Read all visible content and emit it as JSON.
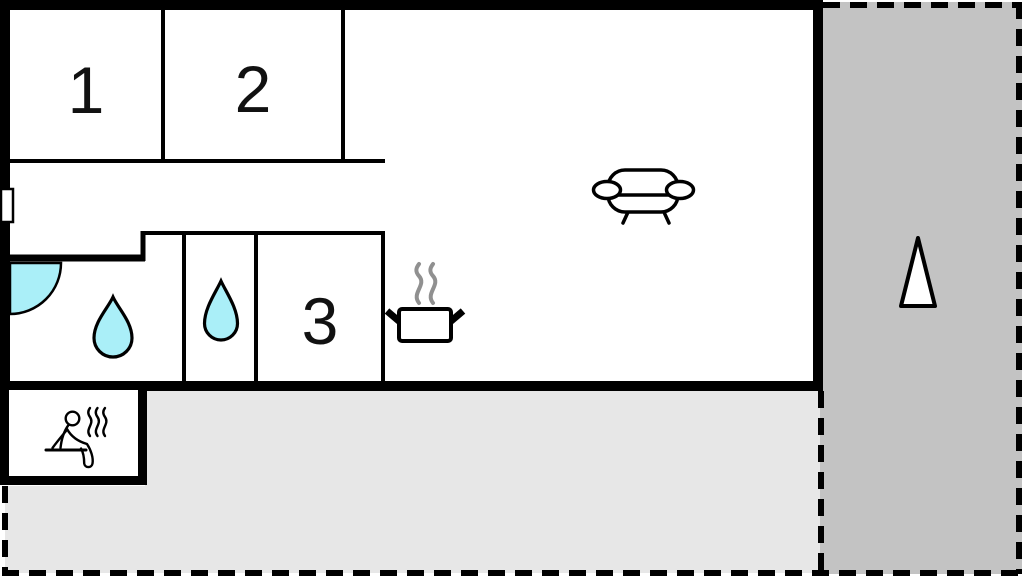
{
  "plan": {
    "type": "holiday-home-floor-plan",
    "rooms": [
      {
        "id": "room-1",
        "label": "1"
      },
      {
        "id": "room-2",
        "label": "2"
      },
      {
        "id": "room-3",
        "label": "3"
      }
    ],
    "icons": [
      "water-drop-icon-large",
      "water-drop-icon-small",
      "sofa-icon",
      "steaming-pot-icon",
      "sauna-person-icon",
      "door-swing-icon",
      "window-marker",
      "north-arrow-icon"
    ],
    "colors": {
      "wall": "#000000",
      "water": "#aaeff8",
      "terrace_main": "#e7e7e7",
      "terrace_side": "#c3c3c3",
      "pot_steam": "#909090",
      "background": "#ffffff"
    }
  }
}
